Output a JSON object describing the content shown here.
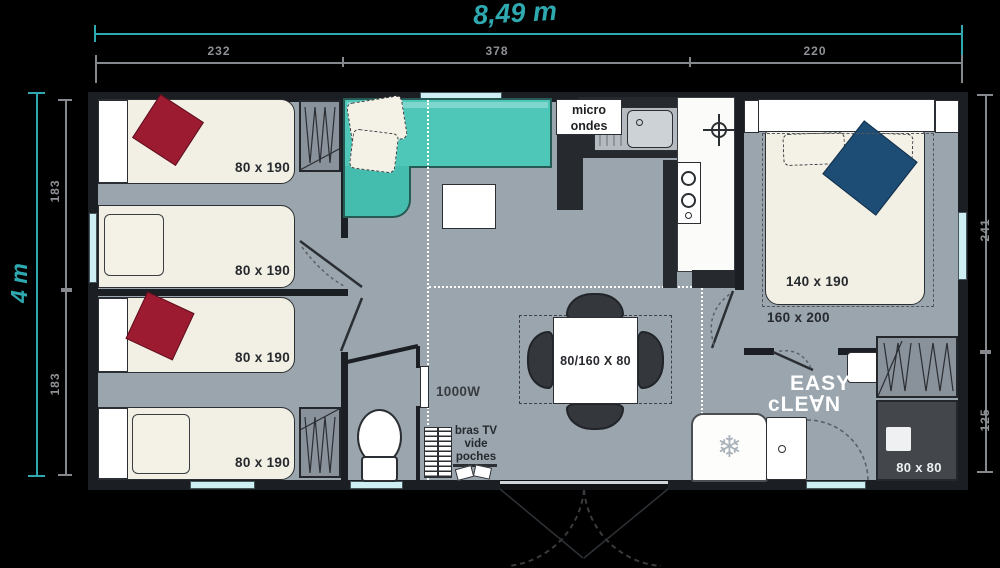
{
  "dimensions": {
    "width_label": "8,49 m",
    "height_label": "4 m",
    "top": [
      "232",
      "378",
      "220"
    ],
    "left": [
      "183",
      "183"
    ],
    "right": [
      "241",
      "125"
    ]
  },
  "labels": {
    "bed1": "80 x 190",
    "bed2": "80 x 190",
    "bed3": "80 x 190",
    "bed4": "80 x 190",
    "master_bed": "140 x 190",
    "master_zone": "160 x 200",
    "table": "80/160 X 80",
    "heater": "1000W",
    "micro_line1": "micro",
    "micro_line2": "ondes",
    "tv_line1": "bras TV",
    "tv_line2": "vide",
    "tv_line3": "poches",
    "brand_line1": "EASY",
    "brand_line2": "cLE∀N",
    "shower": "80 x 80"
  },
  "icons": {
    "freezer_snowflake": "❄"
  },
  "colors": {
    "accent_teal": "#2fa9b0",
    "sofa_teal": "#4ec7b9",
    "floor_gray": "#9aa5ae",
    "wall_dark": "#1b1e22",
    "pillow_red": "#9c1b31",
    "pillow_navy": "#1d4c74",
    "window_blue": "#cdeef3"
  }
}
